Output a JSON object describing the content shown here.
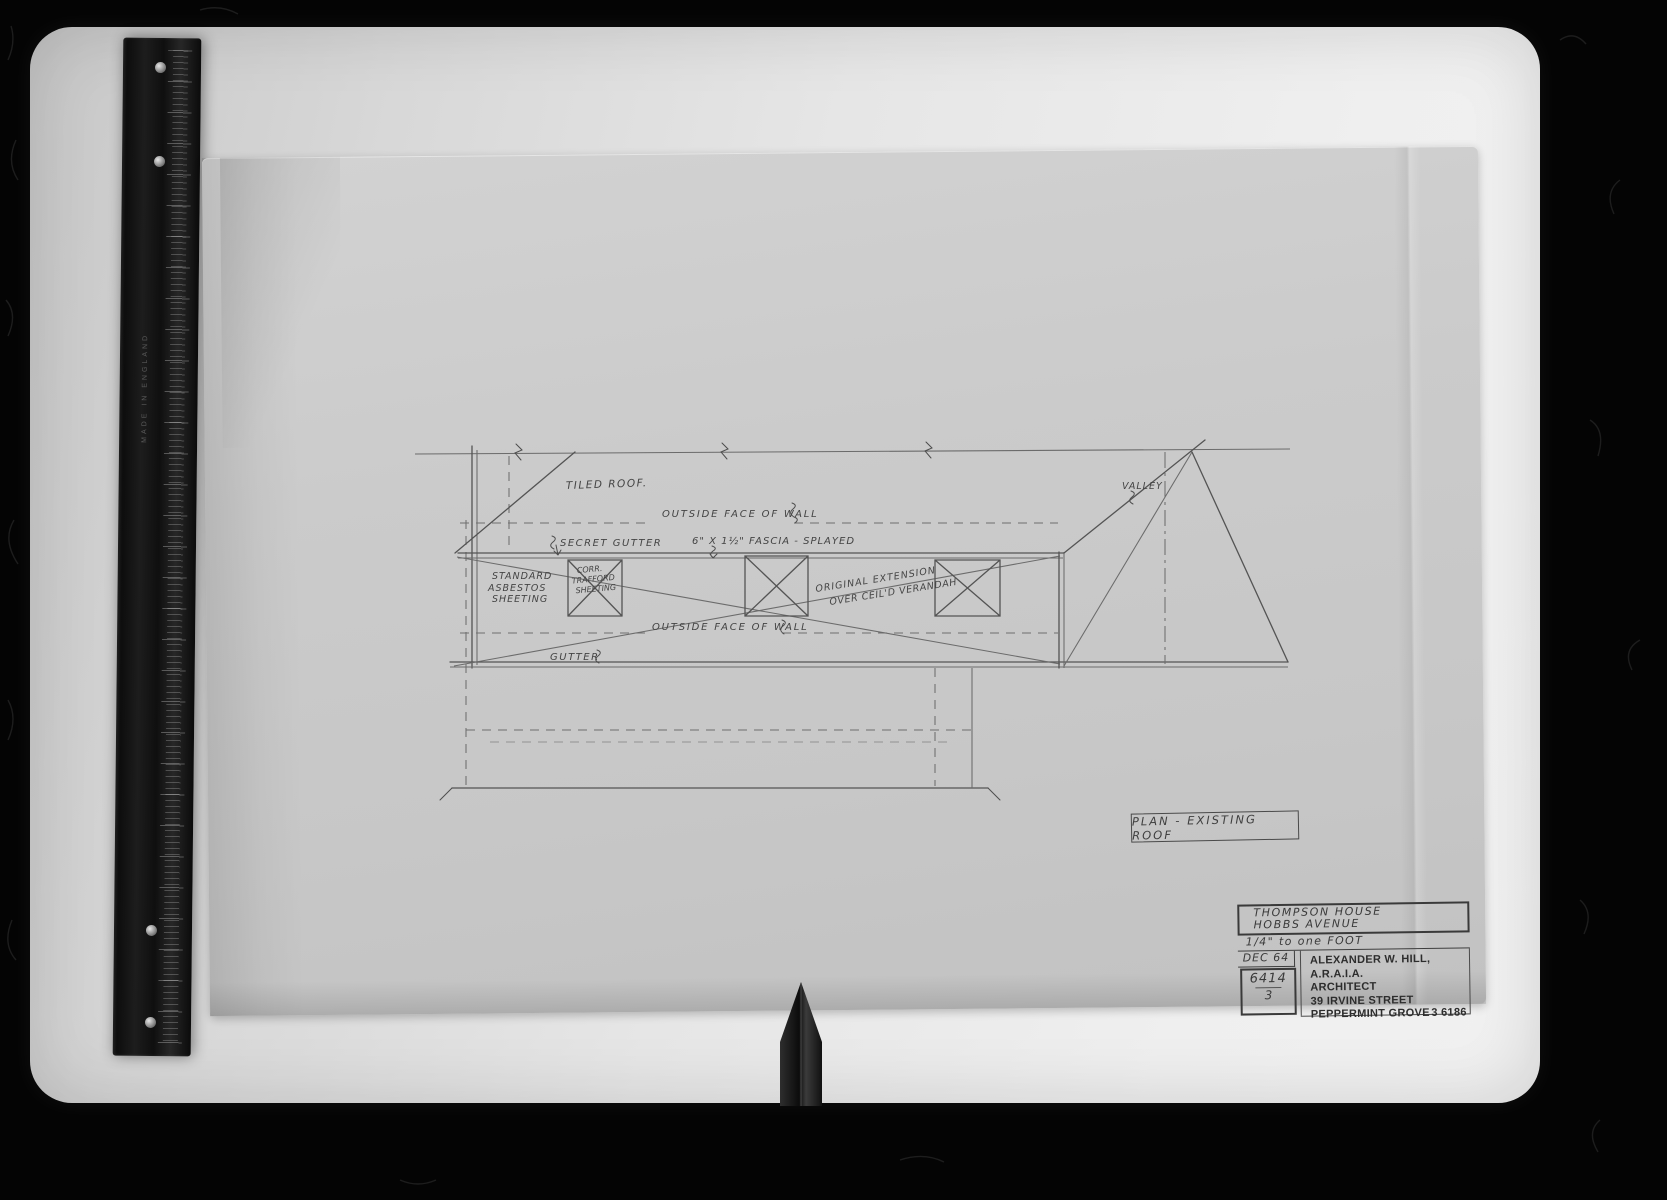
{
  "drawing": {
    "labels": {
      "tiled_roof": "TILED ROOF.",
      "outside_face_wall_top": "OUTSIDE FACE OF WALL",
      "secret_gutter": "SECRET GUTTER",
      "fascia": "6\" X 1½\" FASCIA - SPLAYED",
      "standard_sheeting_1": "STANDARD",
      "standard_sheeting_2": "ASBESTOS",
      "standard_sheeting_3": "SHEETING",
      "corr_sheeting_1": "CORR.",
      "corr_sheeting_2": "TRAFFORD",
      "corr_sheeting_3": "SHEETING",
      "original_extension_1": "ORIGINAL EXTENSION",
      "original_extension_2": "OVER CEIL'D VERANDAH",
      "valley": "VALLEY",
      "outside_face_wall_bottom": "OUTSIDE FACE OF WALL",
      "gutter": "GUTTER"
    },
    "plan_title": "PLAN - EXISTING ROOF"
  },
  "title_block": {
    "project_line_1": "THOMPSON HOUSE",
    "project_line_2": "HOBBS AVENUE",
    "scale": "1/4\" to one FOOT",
    "date": "DEC 64",
    "job_number": "6414",
    "sheet_number": "3",
    "architect_line_1": "ALEXANDER W. HILL, A.R.A.I.A.",
    "architect_line_2": "ARCHITECT",
    "architect_line_3": "39 IRVINE STREET",
    "architect_line_4": "PEPPERMINT GROVE",
    "phone": "3 6186"
  },
  "ruler": {
    "engraving": "MADE IN ENGLAND"
  }
}
